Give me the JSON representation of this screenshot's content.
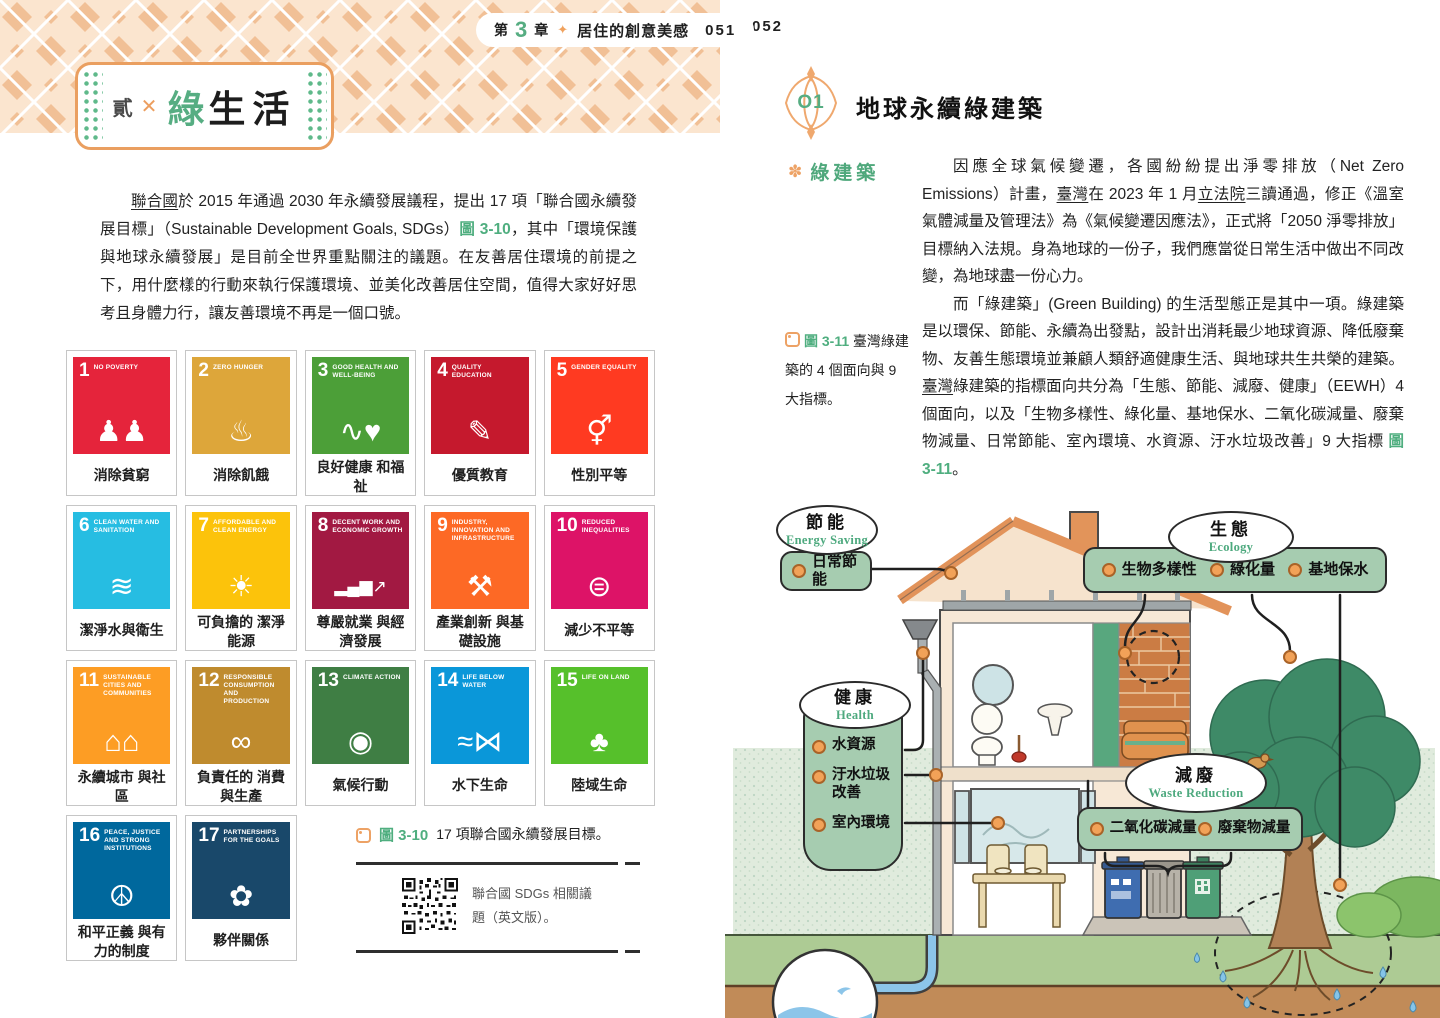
{
  "left_page": {
    "header": {
      "chapter_prefix": "第",
      "chapter_number": "3",
      "chapter_suffix": "章",
      "chapter_title": "居住的創意美感",
      "page_number": "051"
    },
    "title_badge": {
      "index_label": "貳",
      "cross": "✕",
      "title_green": "綠",
      "title_rest": "生活"
    },
    "intro_segments": [
      {
        "t": "聯合國",
        "s": "u"
      },
      {
        "t": "於 2015 年通過 2030 年永續發展議程，提出 17 項「聯合國永續發展目標」（Sustainable Development Goals, SDGs）"
      },
      {
        "t": "圖 3-10",
        "s": "figref"
      },
      {
        "t": "，其中「環境保護與地球永續發展」是目前全世界重點關注的議題。在友善居住環境的前提之下，用什麼樣的行動來執行保護環境、並美化改善居住空間，值得大家好好思考且身體力行，讓友善環境不再是一個口號。"
      }
    ],
    "sdg": {
      "items": [
        {
          "num": "1",
          "en": "NO POVERTY",
          "zh": "消除貧窮",
          "color": "#e5243b",
          "glyph": "♟♟",
          "icon": "family-icon"
        },
        {
          "num": "2",
          "en": "ZERO HUNGER",
          "zh": "消除飢餓",
          "color": "#dda63a",
          "glyph": "♨",
          "icon": "steaming-bowl-icon"
        },
        {
          "num": "3",
          "en": "GOOD HEALTH AND WELL-BEING",
          "zh": "良好健康 和福祉",
          "color": "#4c9f38",
          "glyph": "∿♥",
          "icon": "pulse-heart-icon"
        },
        {
          "num": "4",
          "en": "QUALITY EDUCATION",
          "zh": "優質教育",
          "color": "#c5192d",
          "glyph": "✎",
          "icon": "book-pencil-icon"
        },
        {
          "num": "5",
          "en": "GENDER EQUALITY",
          "zh": "性別平等",
          "color": "#ff3a21",
          "glyph": "⚥",
          "icon": "gender-equality-icon"
        },
        {
          "num": "6",
          "en": "CLEAN WATER AND SANITATION",
          "zh": "潔淨水與衛生",
          "color": "#26bde2",
          "glyph": "≋",
          "icon": "water-glass-icon"
        },
        {
          "num": "7",
          "en": "AFFORDABLE AND CLEAN ENERGY",
          "zh": "可負擔的 潔淨能源",
          "color": "#fcc30b",
          "glyph": "☀",
          "icon": "sun-power-icon"
        },
        {
          "num": "8",
          "en": "DECENT WORK AND ECONOMIC GROWTH",
          "zh": "尊嚴就業 與經濟發展",
          "color": "#a21942",
          "glyph": "▂▄▆↗",
          "icon": "growth-chart-icon"
        },
        {
          "num": "9",
          "en": "INDUSTRY, INNOVATION AND INFRASTRUCTURE",
          "zh": "產業創新 與基礎設施",
          "color": "#fd6925",
          "glyph": "⚒",
          "icon": "industry-cubes-icon"
        },
        {
          "num": "10",
          "en": "REDUCED INEQUALITIES",
          "zh": "減少不平等",
          "color": "#dd1367",
          "glyph": "⊜",
          "icon": "equality-arrows-icon"
        },
        {
          "num": "11",
          "en": "SUSTAINABLE CITIES AND COMMUNITIES",
          "zh": "永續城市 與社區",
          "color": "#fd9d24",
          "glyph": "⌂⌂",
          "icon": "city-buildings-icon"
        },
        {
          "num": "12",
          "en": "RESPONSIBLE CONSUMPTION AND PRODUCTION",
          "zh": "負責任的 消費與生產",
          "color": "#bf8b2e",
          "glyph": "∞",
          "icon": "infinity-loop-icon"
        },
        {
          "num": "13",
          "en": "CLIMATE ACTION",
          "zh": "氣候行動",
          "color": "#3f7e44",
          "glyph": "◉",
          "icon": "eye-globe-icon"
        },
        {
          "num": "14",
          "en": "LIFE BELOW WATER",
          "zh": "水下生命",
          "color": "#0a97d9",
          "glyph": "≈⋈",
          "icon": "fish-waves-icon"
        },
        {
          "num": "15",
          "en": "LIFE ON LAND",
          "zh": "陸域生命",
          "color": "#56c02b",
          "glyph": "♣",
          "icon": "tree-icon"
        },
        {
          "num": "16",
          "en": "PEACE, JUSTICE AND STRONG INSTITUTIONS",
          "zh": "和平正義 與有力的制度",
          "color": "#00689d",
          "glyph": "☮",
          "icon": "dove-gavel-icon"
        },
        {
          "num": "17",
          "en": "PARTNERSHIPS FOR THE GOALS",
          "zh": "夥伴關係",
          "color": "#19486a",
          "glyph": "✿",
          "icon": "interlocked-rings-icon"
        }
      ]
    },
    "figure_caption": {
      "label": "圖 3-10",
      "text": "17 項聯合國永續發展目標。"
    },
    "qr_note": {
      "text": "聯合國 SDGs 相關議題（英文版）。"
    }
  },
  "right_page": {
    "page_number": "052",
    "heading": {
      "badge": "O1",
      "title": "地球永續綠建築"
    },
    "section_label": "綠建築",
    "para1_segments": [
      {
        "t": "因應全球氣候變遷，各國紛紛提出淨零排放（Net Zero Emissions）計畫，"
      },
      {
        "t": "臺灣",
        "s": "u"
      },
      {
        "t": "在 2023 年 1 月"
      },
      {
        "t": "立法院",
        "s": "u"
      },
      {
        "t": "三讀通過，修正《溫室氣體減量及管理法》為《氣候變遷因應法》，正式將「2050 淨零排放」目標納入法規。身為地球的一份子，我們應當從日常生活中做出不同改變，為地球盡一份心力。"
      }
    ],
    "para2_segments": [
      {
        "t": "而「綠建築」(Green Building) 的生活型態正是其中一項。綠建築是以環保、節能、永續為出發點，設計出消耗最少地球資源、降低廢棄物、友善生態環境並兼顧人類舒適健康生活、與地球共生共榮的建築。"
      },
      {
        "t": "臺灣",
        "s": "u"
      },
      {
        "t": "綠建築的指標面向共分為「生態、節能、減廢、健康」（EEWH）4 個面向，以及「生物多樣性、綠化量、基地保水、二氧化碳減量、廢棄物減量、日常節能、室內環境、水資源、汙水垃圾改善」9 大指標 "
      },
      {
        "t": "圖 3-11",
        "s": "figref"
      },
      {
        "t": "。"
      }
    ],
    "figure_caption": {
      "label": "圖 3-11",
      "text": "臺灣綠建築的 4 個面向與 9 大指標。"
    },
    "diagram": {
      "energy": {
        "zh": "節能",
        "en": "Energy Saving",
        "items": [
          "日常節能"
        ]
      },
      "ecology": {
        "zh": "生態",
        "en": "Ecology",
        "items": [
          "生物多樣性",
          "綠化量",
          "基地保水"
        ]
      },
      "health": {
        "zh": "健康",
        "en": "Health",
        "items": [
          "水資源",
          "汙水垃圾改善",
          "室內環境"
        ]
      },
      "waste": {
        "zh": "減廢",
        "en": "Waste Reduction",
        "items": [
          "二氧化碳減量",
          "廢棄物減量"
        ]
      }
    }
  },
  "icons": {
    "sparkle": "✦",
    "flower": "✽"
  },
  "colors": {
    "accent_green": "#56ad82",
    "figref_green": "#4fae7f",
    "accent_orange": "#ec9e5f",
    "label_box_green": "#a6ccb0",
    "dot_orange": "#f2a258"
  }
}
